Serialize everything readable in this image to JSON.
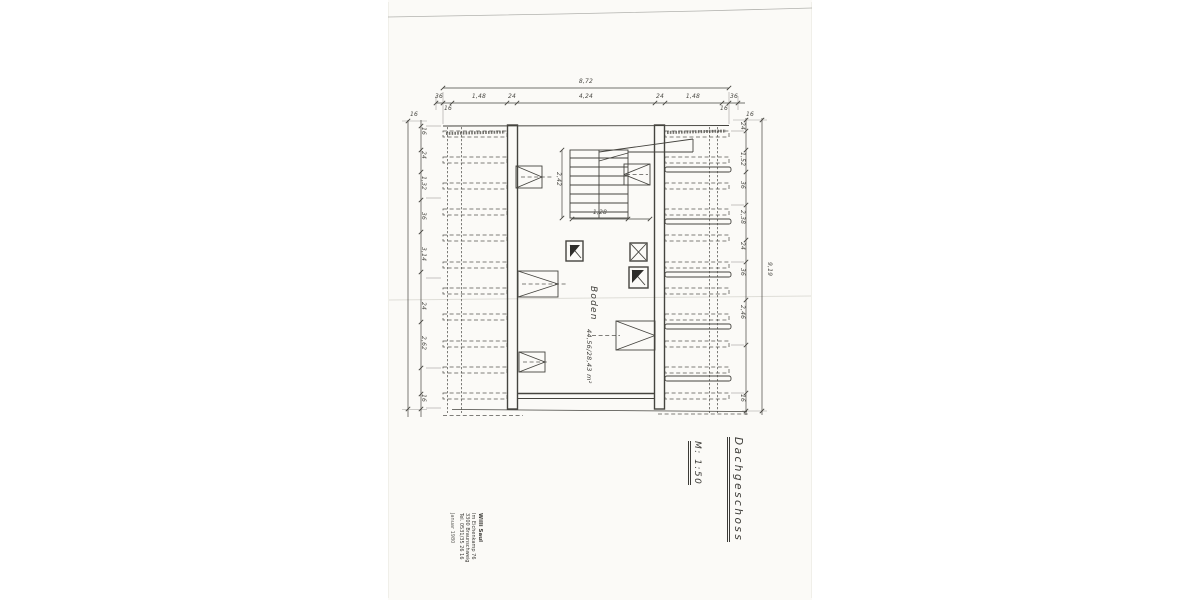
{
  "title_block": {
    "title": "Dachgeschoss",
    "scale": "M: 1:50"
  },
  "room": {
    "name": "Boden",
    "area": "44,56/28,43 m²"
  },
  "stamp": {
    "name": "Willi Saul",
    "address1": "Im Eichenkamp 76",
    "address2": "3300 Braunschweig",
    "address3": "Tel. 0531/35 26 16",
    "date": "Januar 1980"
  },
  "dimensions": {
    "top_total": "8,72",
    "top_chain": [
      "36",
      "16",
      "1,48",
      "24",
      "4,24",
      "24",
      "1,48",
      "16",
      "36"
    ],
    "left_chain": [
      "16",
      "24",
      "1,32",
      "36",
      "3,14",
      "24",
      "2,62",
      "16"
    ],
    "right_chain": [
      "24",
      "1,52",
      "36",
      "2,38",
      "24",
      "36",
      "2,46",
      "16"
    ],
    "right_total": "9,19",
    "corner_left": "16",
    "corner_right": "16",
    "stair_width": "1,28",
    "stair_run": "2,42"
  }
}
